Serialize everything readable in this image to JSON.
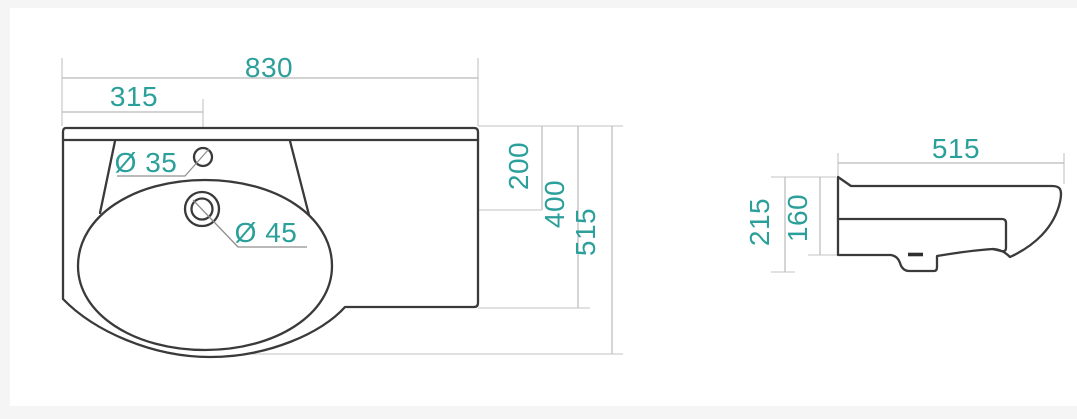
{
  "drawing": {
    "title": "washbasin dimension drawing",
    "colors": {
      "accent": "#2b9f9a",
      "outline": "#3a3a3a",
      "dimension": "#b9b9b9"
    },
    "plan_view": {
      "labels": {
        "overall_width": "830",
        "faucet_offset": "315",
        "faucet_hole": "Ø 35",
        "drain_hole": "Ø 45",
        "drain_center_depth": "200",
        "bowl_section_depth": "400",
        "overall_depth": "515"
      }
    },
    "side_view": {
      "labels": {
        "overall_depth": "515",
        "overall_height": "215",
        "front_height": "160"
      }
    }
  }
}
